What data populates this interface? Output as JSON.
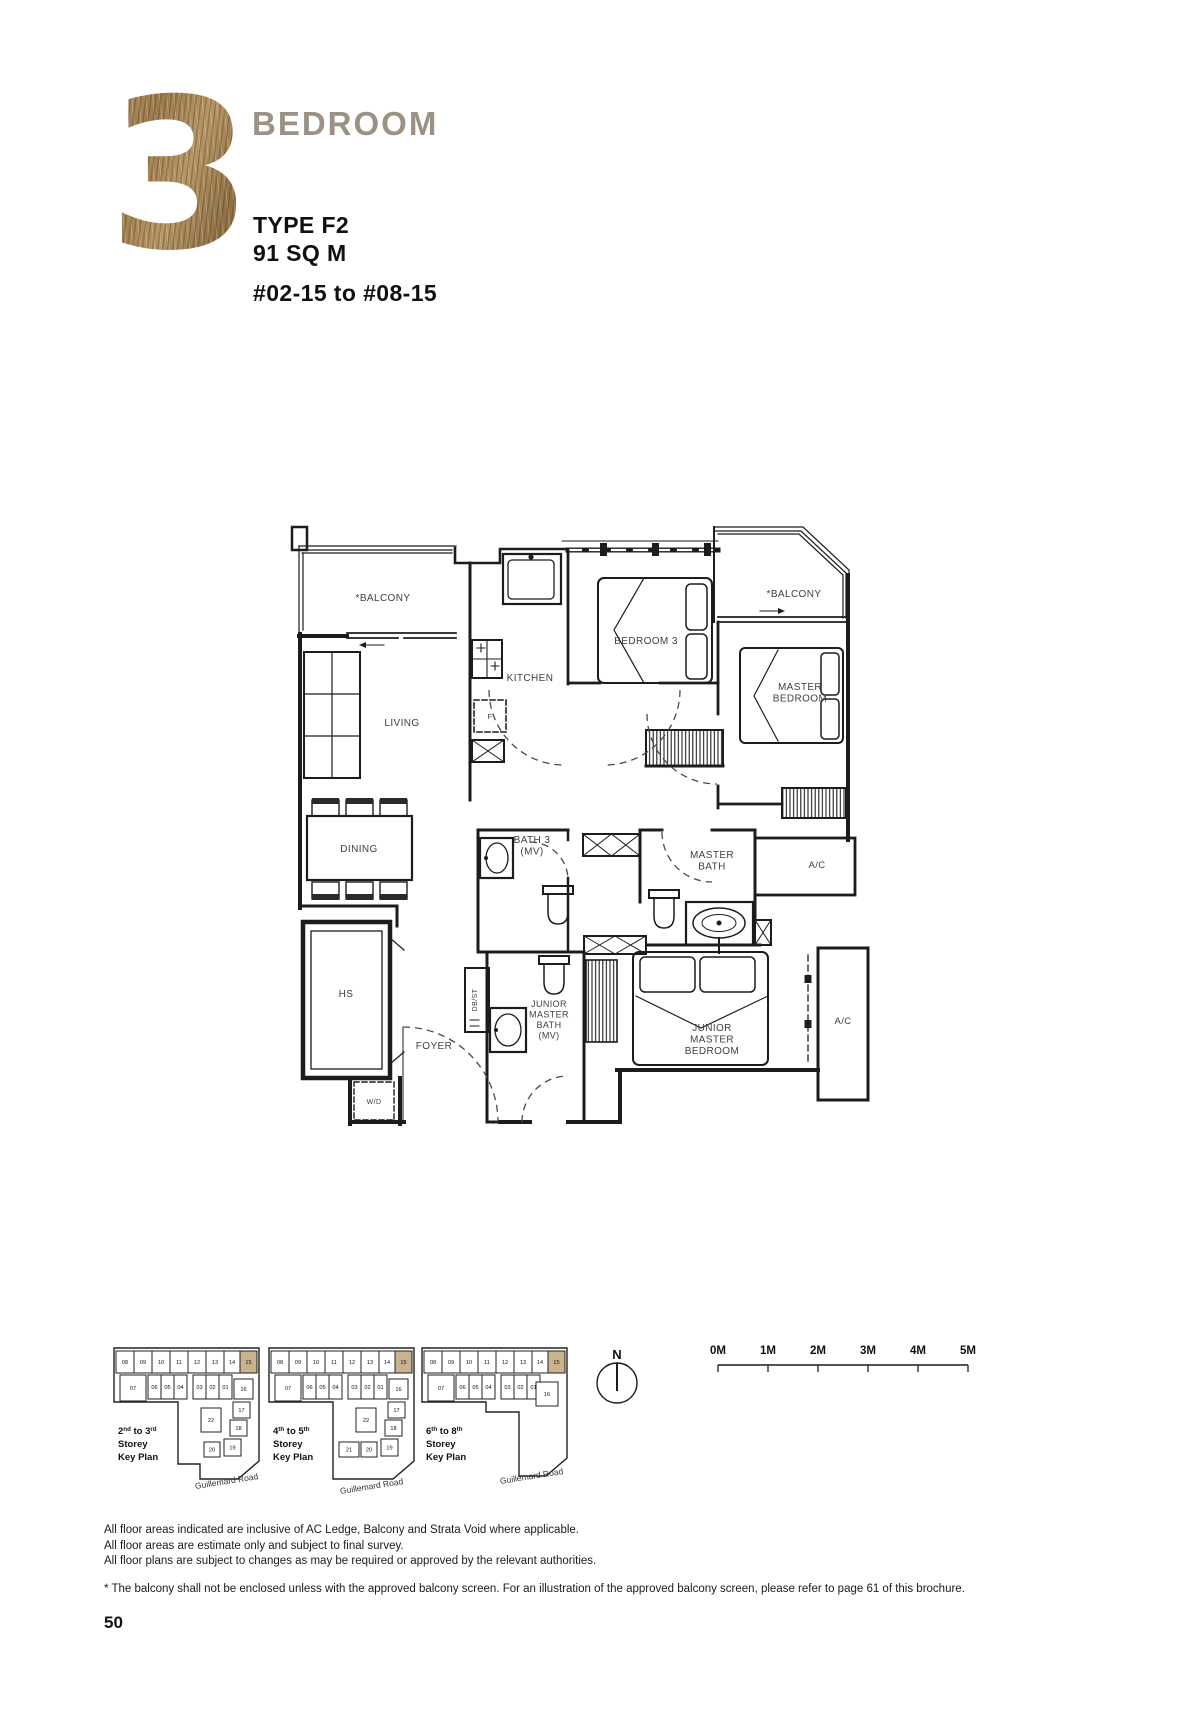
{
  "header": {
    "number": "3",
    "title": "BEDROOM",
    "type": "TYPE F2",
    "area": "91 SQ M",
    "units": "#02-15 to #08-15"
  },
  "colors": {
    "wood_accent": "#a5834f",
    "title_gray": "#9b9285",
    "wall": "#1c1c1c",
    "keyplan_highlight": "#c9b28e"
  },
  "floor_plan": {
    "labels": [
      {
        "lines": [
          "*BALCONY"
        ],
        "x": 383,
        "y": 601
      },
      {
        "lines": [
          "KITCHEN"
        ],
        "x": 530,
        "y": 681
      },
      {
        "lines": [
          "BEDROOM 3"
        ],
        "x": 646,
        "y": 644
      },
      {
        "lines": [
          "*BALCONY"
        ],
        "x": 794,
        "y": 597
      },
      {
        "lines": [
          "MASTER",
          "BEDROOM"
        ],
        "x": 800,
        "y": 690
      },
      {
        "lines": [
          "LIVING"
        ],
        "x": 402,
        "y": 726
      },
      {
        "lines": [
          "F"
        ],
        "x": 490,
        "y": 719,
        "size": 7.5
      },
      {
        "lines": [
          "DINING"
        ],
        "x": 359,
        "y": 852
      },
      {
        "lines": [
          "BATH 3",
          "(MV)"
        ],
        "x": 532,
        "y": 843
      },
      {
        "lines": [
          "MASTER",
          "BATH"
        ],
        "x": 712,
        "y": 858
      },
      {
        "lines": [
          "A/C"
        ],
        "x": 817,
        "y": 868,
        "size": 9.5
      },
      {
        "lines": [
          "HS"
        ],
        "x": 346,
        "y": 997
      },
      {
        "lines": [
          "DB/ST"
        ],
        "x": 477,
        "y": 1000,
        "size": 7,
        "rotate": -90
      },
      {
        "lines": [
          "FOYER"
        ],
        "x": 434,
        "y": 1049
      },
      {
        "lines": [
          "W/D"
        ],
        "x": 374,
        "y": 1104,
        "size": 7
      },
      {
        "lines": [
          "JUNIOR",
          "MASTER",
          "BATH",
          "(MV)"
        ],
        "x": 549,
        "y": 1007,
        "size": 9
      },
      {
        "lines": [
          "JUNIOR",
          "MASTER",
          "BEDROOM"
        ],
        "x": 712,
        "y": 1031
      },
      {
        "lines": [
          "A/C"
        ],
        "x": 843,
        "y": 1024,
        "size": 9.5
      }
    ]
  },
  "compass": {
    "label": "N"
  },
  "scale_bar": {
    "labels": [
      "0M",
      "1M",
      "2M",
      "3M",
      "4M",
      "5M"
    ]
  },
  "key_plans": [
    {
      "x": 112,
      "y": 1346,
      "title_line1": [
        {
          "t": "2"
        },
        {
          "t": "nd",
          "sup": true
        },
        {
          "t": " to 3"
        },
        {
          "t": "rd",
          "sup": true
        }
      ],
      "title_line2": "Storey",
      "title_line3": "Key Plan",
      "outline": "M2,2 H147 V115 L126,133 H88 V118 H66 V56 H2 Z",
      "road": {
        "text": "Guillemard Road",
        "x": 115,
        "y": 138,
        "rotate": -9
      },
      "cells": [
        {
          "n": "08",
          "x": 4,
          "y": 5,
          "w": 18,
          "h": 22
        },
        {
          "n": "09",
          "x": 22,
          "y": 5,
          "w": 18,
          "h": 22
        },
        {
          "n": "10",
          "x": 40,
          "y": 5,
          "w": 18,
          "h": 22
        },
        {
          "n": "11",
          "x": 58,
          "y": 5,
          "w": 18,
          "h": 22
        },
        {
          "n": "12",
          "x": 76,
          "y": 5,
          "w": 18,
          "h": 22
        },
        {
          "n": "13",
          "x": 94,
          "y": 5,
          "w": 18,
          "h": 22
        },
        {
          "n": "14",
          "x": 112,
          "y": 5,
          "w": 16,
          "h": 22
        },
        {
          "n": "15",
          "x": 128,
          "y": 5,
          "w": 17,
          "h": 22,
          "hl": true
        },
        {
          "n": "07",
          "x": 8,
          "y": 29,
          "w": 26,
          "h": 26
        },
        {
          "n": "06",
          "x": 36,
          "y": 29,
          "w": 13,
          "h": 24
        },
        {
          "n": "05",
          "x": 49,
          "y": 29,
          "w": 13,
          "h": 24
        },
        {
          "n": "04",
          "x": 62,
          "y": 29,
          "w": 13,
          "h": 24
        },
        {
          "n": "03",
          "x": 81,
          "y": 29,
          "w": 13,
          "h": 24
        },
        {
          "n": "02",
          "x": 94,
          "y": 29,
          "w": 13,
          "h": 24
        },
        {
          "n": "01",
          "x": 107,
          "y": 29,
          "w": 13,
          "h": 24
        },
        {
          "n": "16",
          "x": 122,
          "y": 33,
          "w": 19,
          "h": 20
        },
        {
          "n": "17",
          "x": 121,
          "y": 56,
          "w": 17,
          "h": 16
        },
        {
          "n": "18",
          "x": 118,
          "y": 74,
          "w": 17,
          "h": 16
        },
        {
          "n": "22",
          "x": 89,
          "y": 62,
          "w": 20,
          "h": 24
        },
        {
          "n": "19",
          "x": 112,
          "y": 93,
          "w": 17,
          "h": 17
        },
        {
          "n": "20",
          "x": 92,
          "y": 96,
          "w": 16,
          "h": 15
        }
      ]
    },
    {
      "x": 267,
      "y": 1346,
      "title_line1": [
        {
          "t": "4"
        },
        {
          "t": "th",
          "sup": true
        },
        {
          "t": " to 5"
        },
        {
          "t": "th",
          "sup": true
        }
      ],
      "title_line2": "Storey",
      "title_line3": "Key Plan",
      "outline": "M2,2 H147 V115 L126,133 H66 V56 H2 Z",
      "road": {
        "text": "Guillemard Road",
        "x": 105,
        "y": 143,
        "rotate": -9
      },
      "cells": [
        {
          "n": "08",
          "x": 4,
          "y": 5,
          "w": 18,
          "h": 22
        },
        {
          "n": "09",
          "x": 22,
          "y": 5,
          "w": 18,
          "h": 22
        },
        {
          "n": "10",
          "x": 40,
          "y": 5,
          "w": 18,
          "h": 22
        },
        {
          "n": "11",
          "x": 58,
          "y": 5,
          "w": 18,
          "h": 22
        },
        {
          "n": "12",
          "x": 76,
          "y": 5,
          "w": 18,
          "h": 22
        },
        {
          "n": "13",
          "x": 94,
          "y": 5,
          "w": 18,
          "h": 22
        },
        {
          "n": "14",
          "x": 112,
          "y": 5,
          "w": 16,
          "h": 22
        },
        {
          "n": "15",
          "x": 128,
          "y": 5,
          "w": 17,
          "h": 22,
          "hl": true
        },
        {
          "n": "07",
          "x": 8,
          "y": 29,
          "w": 26,
          "h": 26
        },
        {
          "n": "06",
          "x": 36,
          "y": 29,
          "w": 13,
          "h": 24
        },
        {
          "n": "05",
          "x": 49,
          "y": 29,
          "w": 13,
          "h": 24
        },
        {
          "n": "04",
          "x": 62,
          "y": 29,
          "w": 13,
          "h": 24
        },
        {
          "n": "03",
          "x": 81,
          "y": 29,
          "w": 13,
          "h": 24
        },
        {
          "n": "02",
          "x": 94,
          "y": 29,
          "w": 13,
          "h": 24
        },
        {
          "n": "01",
          "x": 107,
          "y": 29,
          "w": 13,
          "h": 24
        },
        {
          "n": "16",
          "x": 122,
          "y": 33,
          "w": 19,
          "h": 20
        },
        {
          "n": "17",
          "x": 121,
          "y": 56,
          "w": 17,
          "h": 16
        },
        {
          "n": "18",
          "x": 118,
          "y": 74,
          "w": 17,
          "h": 16
        },
        {
          "n": "22",
          "x": 89,
          "y": 62,
          "w": 20,
          "h": 24
        },
        {
          "n": "19",
          "x": 114,
          "y": 93,
          "w": 17,
          "h": 17
        },
        {
          "n": "20",
          "x": 94,
          "y": 96,
          "w": 16,
          "h": 15
        },
        {
          "n": "21",
          "x": 72,
          "y": 96,
          "w": 20,
          "h": 15
        }
      ]
    },
    {
      "x": 420,
      "y": 1346,
      "title_line1": [
        {
          "t": "6"
        },
        {
          "t": "th",
          "sup": true
        },
        {
          "t": " to 8"
        },
        {
          "t": "th",
          "sup": true
        }
      ],
      "title_line2": "Storey",
      "title_line3": "Key Plan",
      "outline": "M2,2 H147 V112 L126,130 H99 V66 H66 V56 H2 Z",
      "road": {
        "text": "Guillemard Road",
        "x": 112,
        "y": 133,
        "rotate": -9
      },
      "cells": [
        {
          "n": "08",
          "x": 4,
          "y": 5,
          "w": 18,
          "h": 22
        },
        {
          "n": "09",
          "x": 22,
          "y": 5,
          "w": 18,
          "h": 22
        },
        {
          "n": "10",
          "x": 40,
          "y": 5,
          "w": 18,
          "h": 22
        },
        {
          "n": "11",
          "x": 58,
          "y": 5,
          "w": 18,
          "h": 22
        },
        {
          "n": "12",
          "x": 76,
          "y": 5,
          "w": 18,
          "h": 22
        },
        {
          "n": "13",
          "x": 94,
          "y": 5,
          "w": 18,
          "h": 22
        },
        {
          "n": "14",
          "x": 112,
          "y": 5,
          "w": 16,
          "h": 22
        },
        {
          "n": "15",
          "x": 128,
          "y": 5,
          "w": 17,
          "h": 22,
          "hl": true
        },
        {
          "n": "07",
          "x": 8,
          "y": 29,
          "w": 26,
          "h": 26
        },
        {
          "n": "06",
          "x": 36,
          "y": 29,
          "w": 13,
          "h": 24
        },
        {
          "n": "05",
          "x": 49,
          "y": 29,
          "w": 13,
          "h": 24
        },
        {
          "n": "04",
          "x": 62,
          "y": 29,
          "w": 13,
          "h": 24
        },
        {
          "n": "03",
          "x": 81,
          "y": 29,
          "w": 13,
          "h": 24
        },
        {
          "n": "02",
          "x": 94,
          "y": 29,
          "w": 13,
          "h": 24
        },
        {
          "n": "01",
          "x": 107,
          "y": 29,
          "w": 13,
          "h": 24
        },
        {
          "n": "16",
          "x": 116,
          "y": 36,
          "w": 22,
          "h": 24
        }
      ]
    }
  ],
  "footnotes": {
    "lines": [
      "All floor areas indicated are inclusive of AC Ledge, Balcony and Strata Void where applicable.",
      "All floor areas are estimate only and subject to final survey.",
      "All floor plans are subject to changes as may be required or approved by the relevant authorities."
    ],
    "balcony_note": "* The balcony shall not be enclosed unless with the approved balcony screen. For an illustration of the approved balcony screen, please refer to page 61 of this brochure."
  },
  "page_number": "50"
}
